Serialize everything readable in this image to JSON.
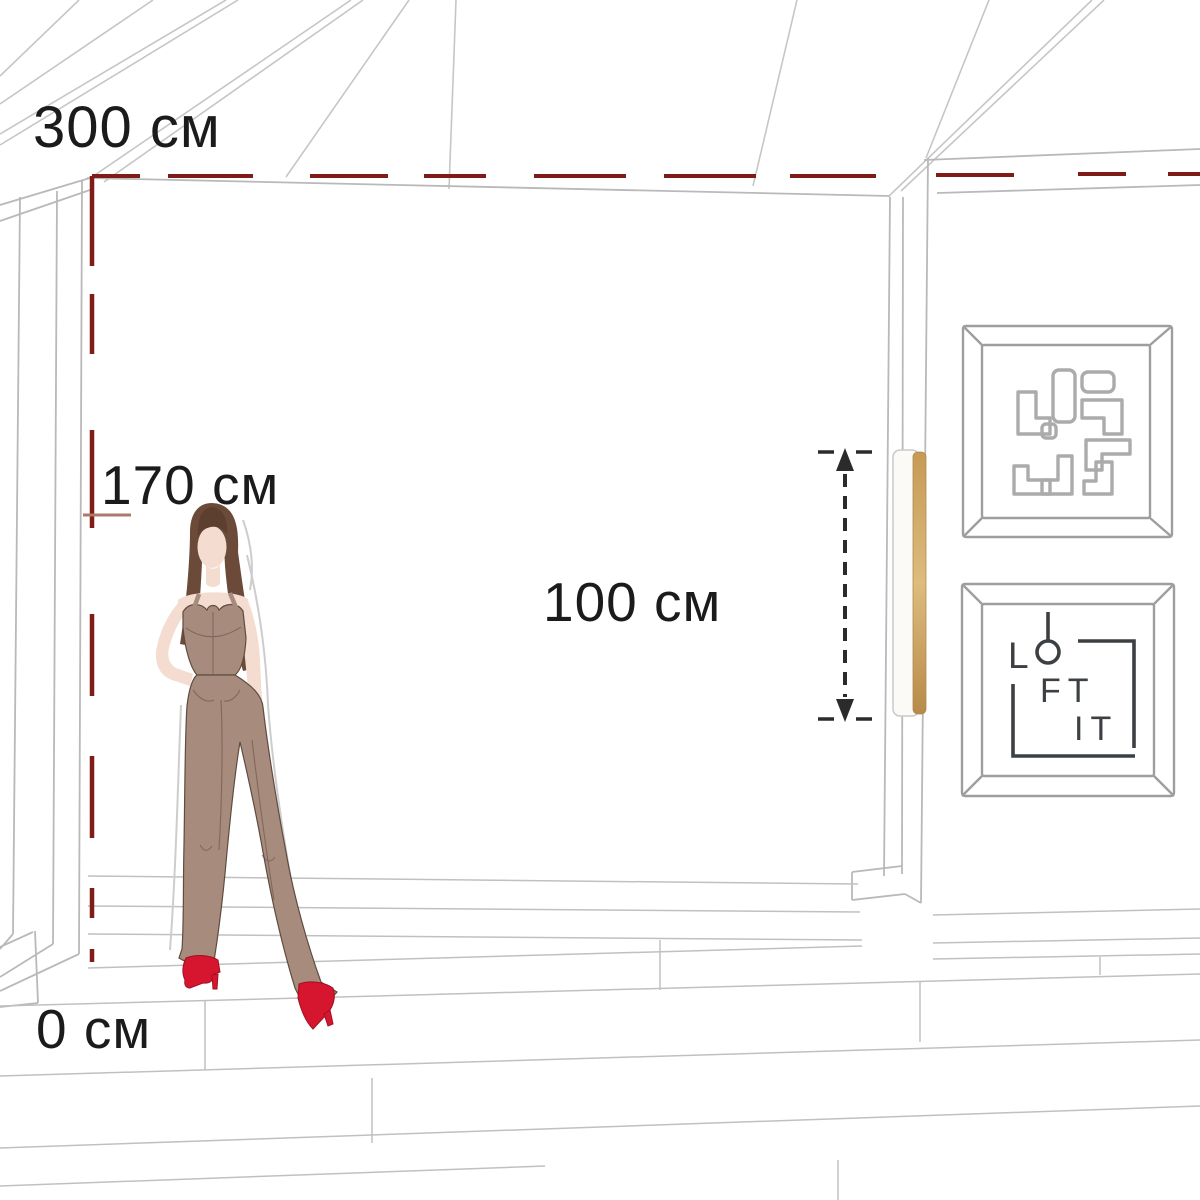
{
  "measurements": {
    "ceiling_height": "300 см",
    "mounting_height": "170 см",
    "lamp_length": "100 см",
    "floor_level": "0 см"
  },
  "logo": {
    "letters_top": "L",
    "letters_mid": "FT",
    "letters_bottom": "IT"
  },
  "artworks": {
    "top_frame": "maze-artwork",
    "bottom_frame": "loft-it-logo-artwork"
  },
  "colors": {
    "accent_red": "#7f1c17",
    "tick_rose": "#ab7a6c",
    "measure_black": "#2b2b2b",
    "sketch_gray": "#c6c6c6",
    "lamp_gold": "#c9a05c",
    "outfit_taupe": "#a78c7e",
    "skin": "#f4ddd0",
    "hair_brown": "#6b4a39",
    "shoe_red": "#d5162e",
    "logo_ink": "#3d4043",
    "text_ink": "#1b1b1b"
  }
}
